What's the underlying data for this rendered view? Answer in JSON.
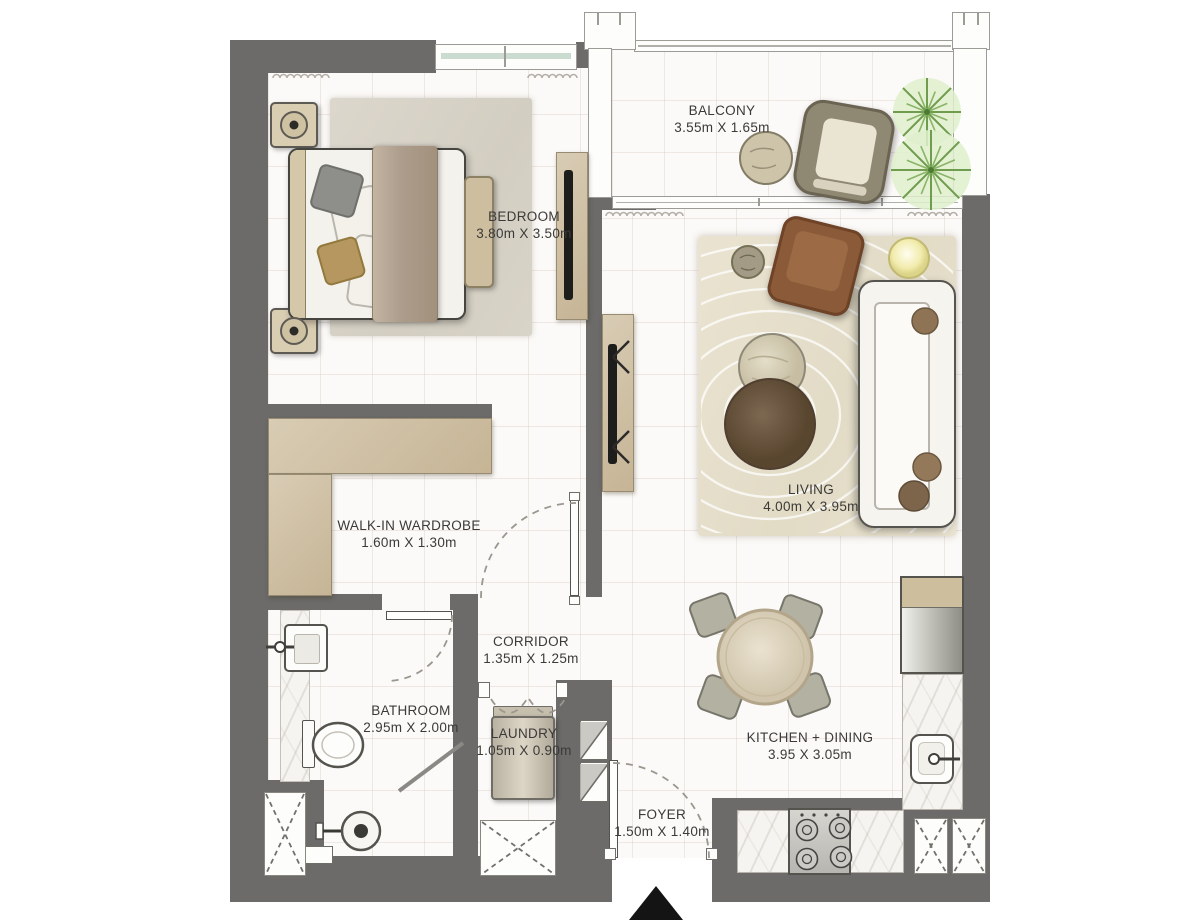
{
  "plan": {
    "rooms": [
      {
        "id": "balcony",
        "name": "BALCONY",
        "dims": "3.55m X 1.65m"
      },
      {
        "id": "bedroom",
        "name": "BEDROOM",
        "dims": "3.80m X 3.50m"
      },
      {
        "id": "living",
        "name": "LIVING",
        "dims": "4.00m X 3.95m"
      },
      {
        "id": "wardrobe",
        "name": "WALK-IN WARDROBE",
        "dims": "1.60m X 1.30m"
      },
      {
        "id": "corridor",
        "name": "CORRIDOR",
        "dims": "1.35m X 1.25m"
      },
      {
        "id": "bathroom",
        "name": "BATHROOM",
        "dims": "2.95m X 2.00m"
      },
      {
        "id": "laundry",
        "name": "LAUNDRY",
        "dims": "1.05m X 0.90m"
      },
      {
        "id": "kitchen",
        "name": "KITCHEN + DINING",
        "dims": "3.95 X 3.05m"
      },
      {
        "id": "foyer",
        "name": "FOYER",
        "dims": "1.50m X 1.40m"
      }
    ],
    "colors": {
      "wall": "#6c6b69",
      "floor": "#fcfaf8",
      "wood": "#cdbf9e",
      "rug_living": "#e7e0cd",
      "rug_bedroom": "#d9d4c9",
      "sofa": "#f6f4ee",
      "armchair": "#8a5a39",
      "table_dark": "#6b573f",
      "plant": "#6f9c4f",
      "outline": "#55534e",
      "entry_marker": "#141414"
    }
  }
}
